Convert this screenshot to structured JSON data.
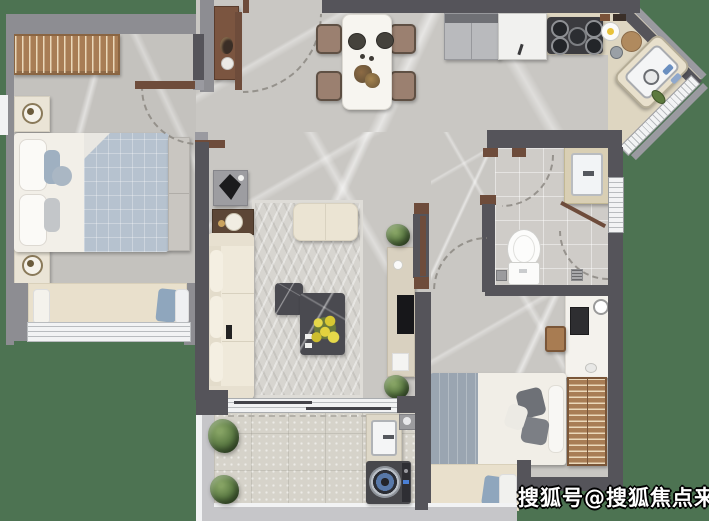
{
  "watermark": {
    "text": "搜狐号@搜狐焦点来宾站"
  },
  "palette": {
    "background_green": "#4d7352",
    "exterior_wall_gray": "#8d8d92",
    "interior_wall_dark": "#55545a",
    "door_frame_brown": "#6e4c3b",
    "floor_marble": "#c9c7c3",
    "bathroom_tile": "#cfccc8",
    "balcony_floor": "#d6d3ca",
    "kitchen_counter": "#ded6c1",
    "furniture_wood": "#a87d55",
    "sofa_cream": "#efe9da",
    "bedding_blue_gray": "#b6c2cf",
    "plant_green": "#5d7c45",
    "flower_yellow": "#ddc93e",
    "window_white": "#f2f3f4"
  },
  "plan": {
    "type": "apartment-floor-plan",
    "rooms": [
      {
        "name": "master-bedroom",
        "furniture": [
          "wardrobe",
          "double-bed",
          "two-nightstands-with-lamps",
          "foot-bench",
          "bay-window-seat-with-pillows"
        ]
      },
      {
        "name": "entry",
        "furniture": [
          "console-table-with-vase",
          "entry-door-swing"
        ]
      },
      {
        "name": "dining-area",
        "furniture": [
          "dining-table",
          "four-chairs",
          "plates",
          "centerpiece"
        ]
      },
      {
        "name": "kitchen",
        "furniture": [
          "fridge",
          "tall-cabinet",
          "gas-stove",
          "breakfast-plates",
          "corner-sink",
          "diagonal-window"
        ]
      },
      {
        "name": "bathroom",
        "furniture": [
          "vanity-sink",
          "toilet",
          "shower-with-corner-door",
          "floor-drain",
          "window"
        ]
      },
      {
        "name": "living-room",
        "furniture": [
          "sideboard-with-sculpture",
          "side-table-with-lamp",
          "sofa",
          "patterned-rug",
          "ottoman",
          "two-marble-coffee-tables",
          "yellow-flowers",
          "tv-console",
          "plants"
        ]
      },
      {
        "name": "hallway",
        "furniture": [
          "door-swing-arcs"
        ]
      },
      {
        "name": "second-bedroom",
        "furniture": [
          "desk-with-lamp",
          "desk-chair",
          "single-bed",
          "wardrobe",
          "bay-window-seat-with-pillows"
        ]
      },
      {
        "name": "balcony",
        "furniture": [
          "sliding-door",
          "laundry-sink",
          "washing-machine",
          "floor-drain",
          "two-plants"
        ]
      }
    ]
  }
}
